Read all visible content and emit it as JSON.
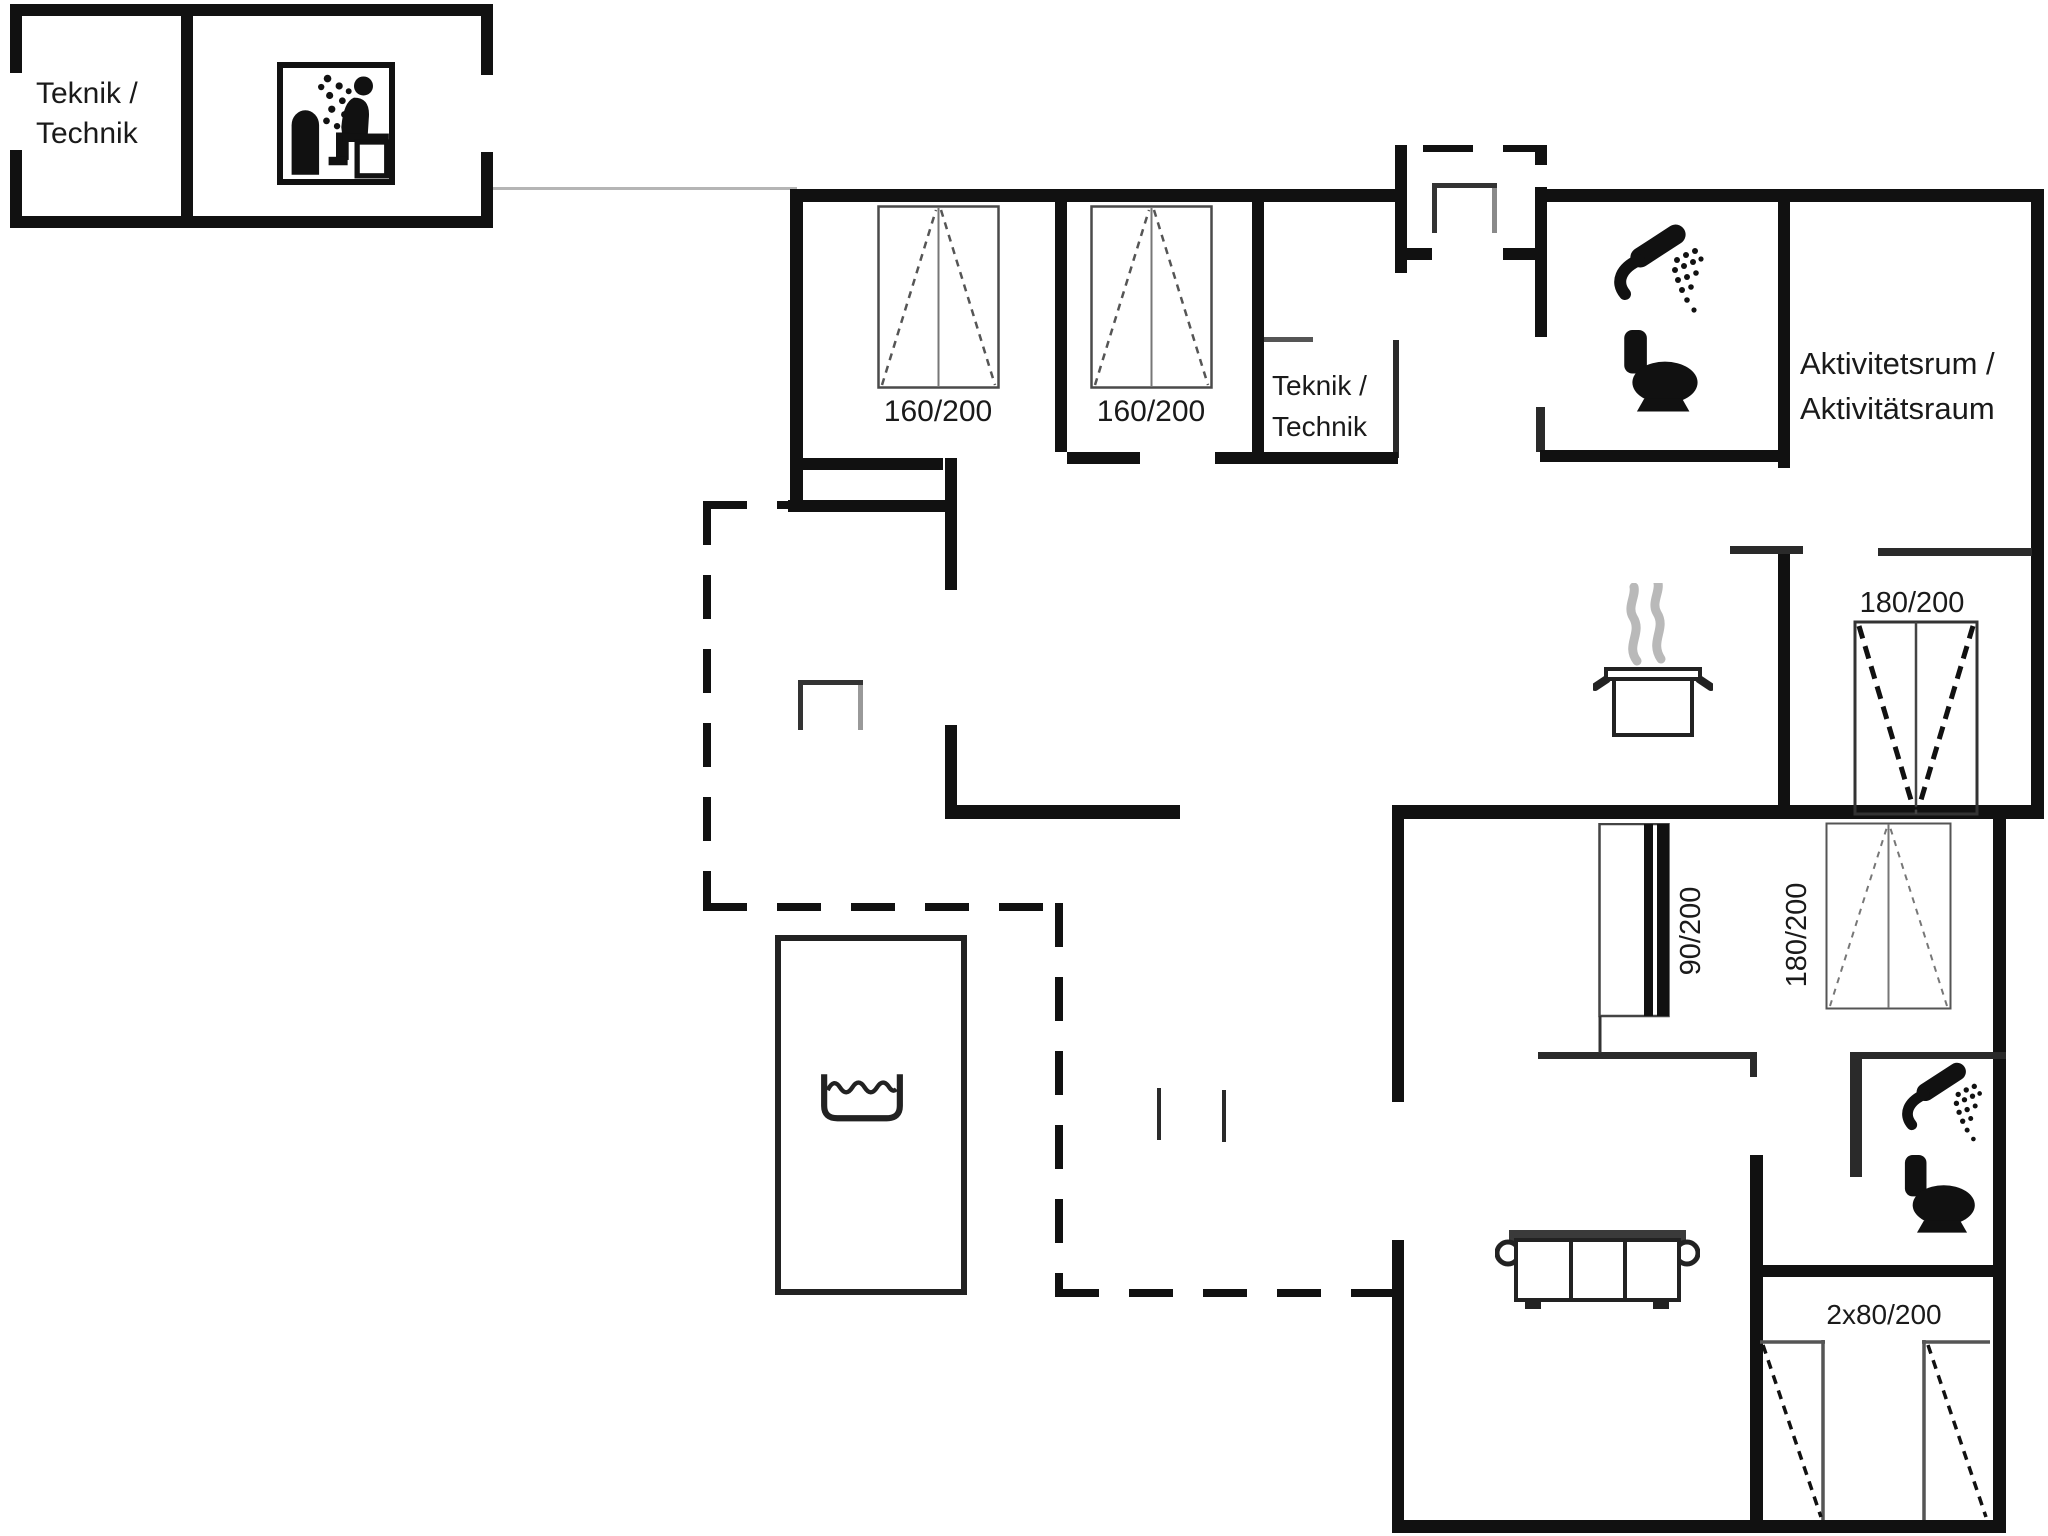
{
  "outbuilding": {
    "label_line1": "Teknik /",
    "label_line2": "Technik"
  },
  "rooms": {
    "teknik": {
      "line1": "Teknik /",
      "line2": "Technik"
    },
    "activity": {
      "line1": "Aktivitetsrum /",
      "line2": "Aktivitätsraum"
    }
  },
  "beds": {
    "bed1": "160/200",
    "bed2": "160/200",
    "bed_double_upper": "180/200",
    "bed_double_lower": "180/200",
    "bed_bunk": "90/200",
    "bed_twin": "2x80/200"
  },
  "icons": [
    "sauna-icon",
    "shower-icon",
    "toilet-icon",
    "cooking-pot-icon",
    "steam-icon",
    "bathtub-icon",
    "sofa-icon",
    "door-icon",
    "bed-symbol"
  ],
  "colors": {
    "wall": "#111111",
    "thin_line": "#555555",
    "steam": "#b9b9b9",
    "text": "#1a1a1a"
  }
}
